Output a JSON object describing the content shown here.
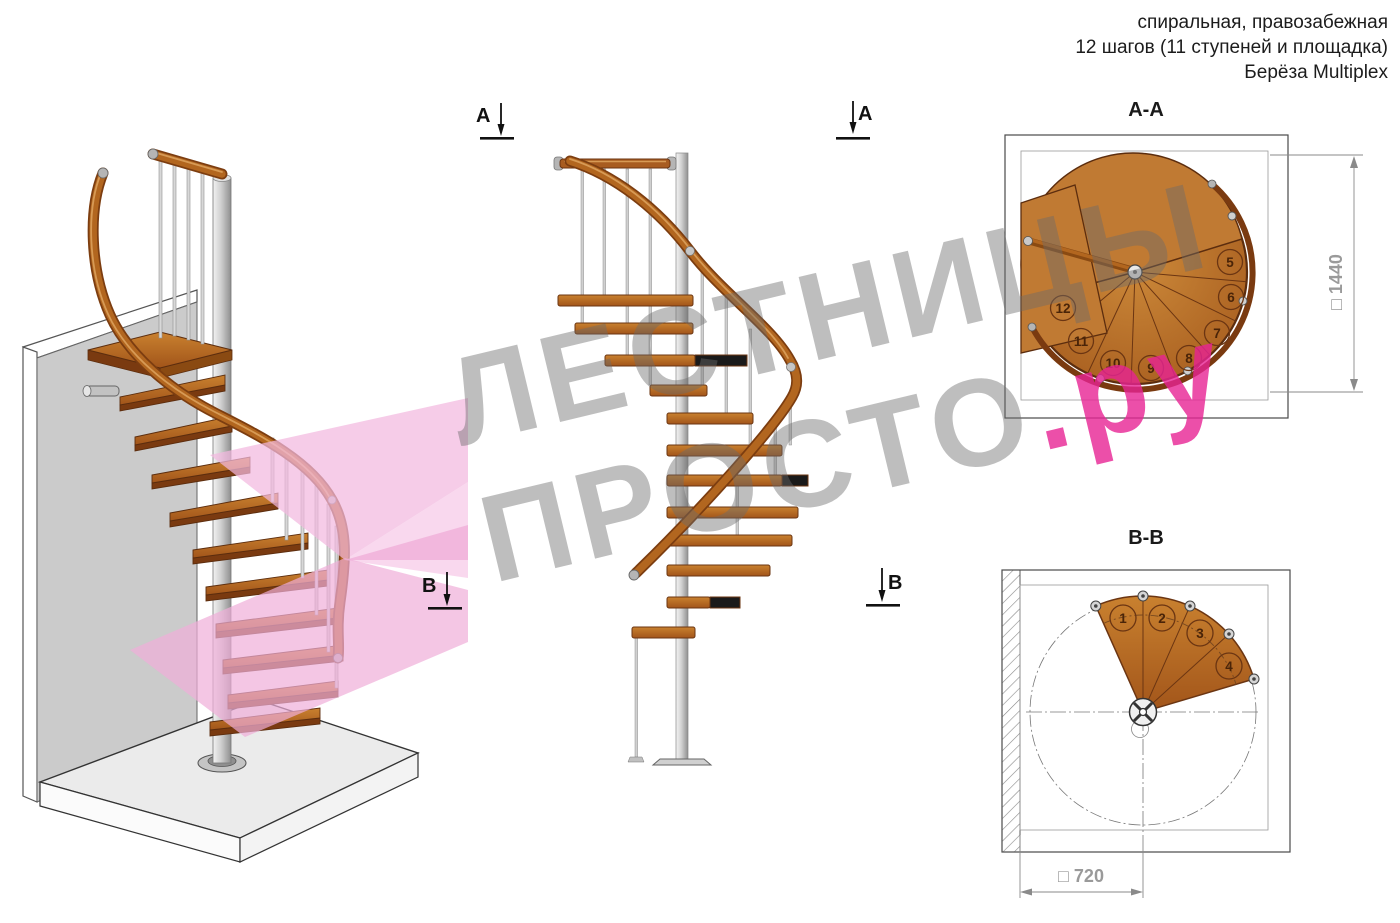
{
  "header": {
    "line1": "спиральная, правозабежная",
    "line2": "12 шагов (11 ступеней и площадка)",
    "line3": "Берёза Multiplex"
  },
  "watermark": {
    "line1": "ЛЕСТНИЦЫ",
    "line2": "ПРОСТО",
    "suffix": ".ру"
  },
  "markers": {
    "a": "А",
    "b": "В"
  },
  "plans": {
    "aa": {
      "title": "А-А",
      "dimension_label": "□ 1440",
      "dimension_value": "1440",
      "step_numbers": [
        "5",
        "6",
        "7",
        "8",
        "9",
        "10",
        "11",
        "12"
      ]
    },
    "bb": {
      "title": "В-В",
      "dimension_label": "□ 720",
      "dimension_value": "720",
      "step_numbers": [
        "1",
        "2",
        "3",
        "4"
      ]
    }
  },
  "colors": {
    "wood": "#b2661f",
    "wood_dark": "#6b3512",
    "metal": "#c9c9c9",
    "pink_plane": "#f3b8df",
    "watermark_gray": "#b9b9b9",
    "watermark_pink": "#e6309a",
    "dimension_gray": "#9a9a9a"
  }
}
